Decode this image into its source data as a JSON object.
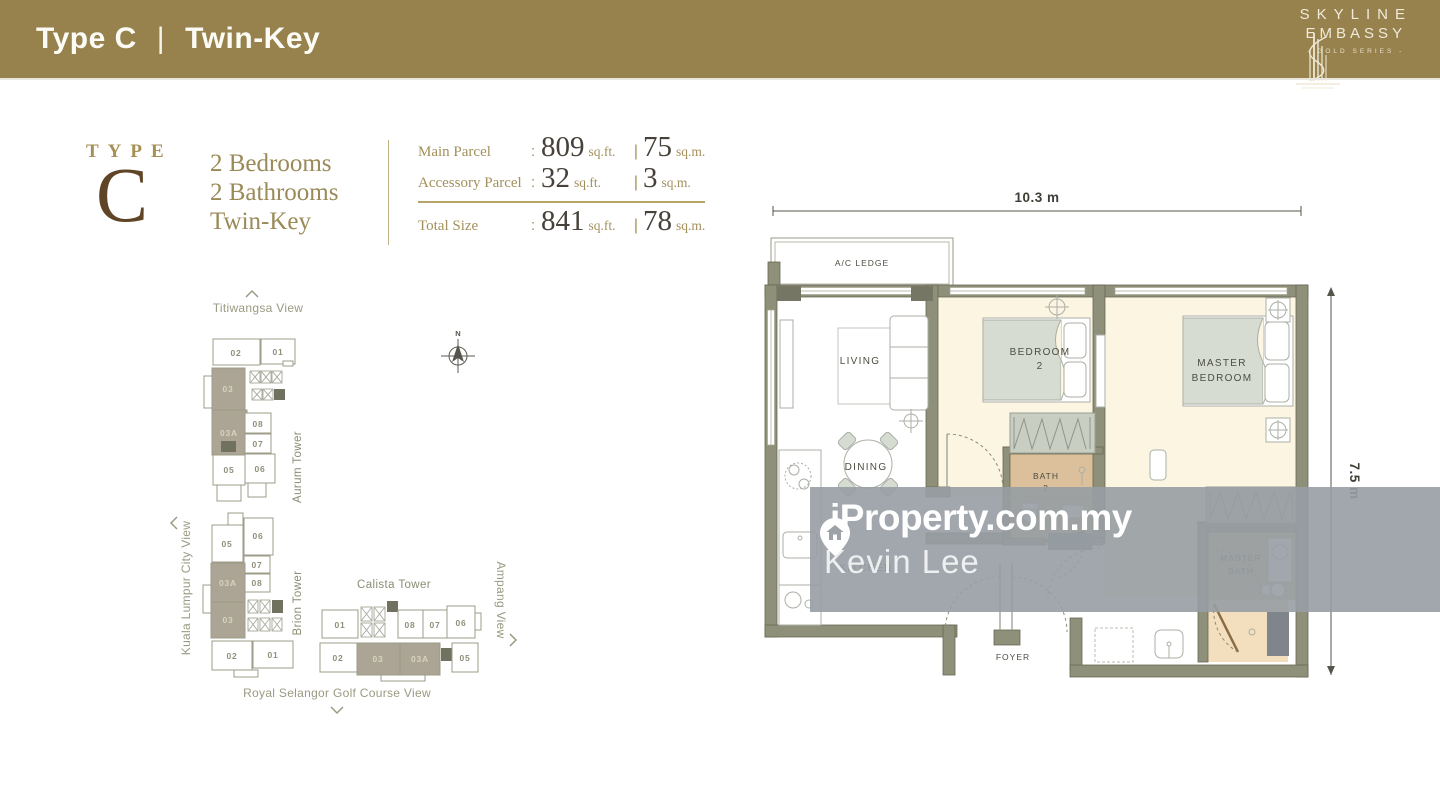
{
  "colors": {
    "header_bar": "#97824E",
    "accent_gold": "#A3905C",
    "type_letter_brown": "#5F4526",
    "highlight_unit": "#ACA595",
    "wall_olive": "#8F9079",
    "bedroom_floor_cream": "#FBF5E2",
    "bath_floor_tan": "#DCC09B",
    "watermark_band_gray": "#9AA0A6"
  },
  "header": {
    "title_left": "Type C",
    "separator": "|",
    "title_right": "Twin-Key",
    "brand": {
      "line1": "SKYLINE",
      "line2": "EMBASSY",
      "tagline": "- GOLD SERIES -"
    }
  },
  "unit_info": {
    "type_label": "TYPE",
    "type_letter": "C",
    "features": [
      "2 Bedrooms",
      "2 Bathrooms",
      "Twin-Key"
    ],
    "sizes": {
      "main": {
        "label": "Main Parcel",
        "colon": ":",
        "sqft": "809",
        "sqft_unit": "sq.ft.",
        "pipe": "|",
        "sqm": "75",
        "sqm_unit": "sq.m."
      },
      "accessory": {
        "label": "Accessory Parcel",
        "colon": ":",
        "sqft": "32",
        "sqft_unit": "sq.ft.",
        "pipe": "|",
        "sqm": "3",
        "sqm_unit": "sq.m."
      },
      "total": {
        "label": "Total Size",
        "colon": ":",
        "sqft": "841",
        "sqft_unit": "sq.ft.",
        "pipe": "|",
        "sqm": "78",
        "sqm_unit": "sq.m."
      }
    }
  },
  "site_plan": {
    "compass": "N",
    "views": {
      "top": "Titiwangsa View",
      "left": "Kuala Lumpur City View",
      "right": "Ampang View",
      "bottom": "Royal Selangor Golf Course View"
    },
    "towers": {
      "aurum": {
        "name": "Aurum Tower",
        "units": {
          "u02": "02",
          "u01": "01",
          "u03": "03",
          "u03a": "03A",
          "u05": "05",
          "u08": "08",
          "u07": "07",
          "u06": "06"
        }
      },
      "brion": {
        "name": "Brion Tower",
        "units": {
          "u05": "05",
          "u06": "06",
          "u07": "07",
          "u08": "08",
          "u03a": "03A",
          "u03": "03",
          "u02": "02",
          "u01": "01"
        }
      },
      "calista": {
        "name": "Calista Tower",
        "units": {
          "u01": "01",
          "u08": "08",
          "u07": "07",
          "u06": "06",
          "u02": "02",
          "u03": "03",
          "u03a": "03A",
          "u05": "05"
        }
      }
    },
    "highlighted_units": [
      "03",
      "03A"
    ]
  },
  "floor_plan": {
    "dimensions": {
      "width": "10.3 m",
      "height": "7.5 m"
    },
    "rooms": {
      "ac_ledge": "A/C LEDGE",
      "living": "LIVING",
      "dining": "DINING",
      "kitchen": "KITCHEN",
      "bedroom2_line1": "BEDROOM",
      "bedroom2_line2": "2",
      "master_bedroom_line1": "MASTER",
      "master_bedroom_line2": "BEDROOM",
      "bath2_line1": "BATH",
      "bath2_line2": "2",
      "master_bath_line1": "MASTER",
      "master_bath_line2": "BATH",
      "foyer": "FOYER"
    }
  },
  "watermark": {
    "brand": "iProperty.com.my",
    "agent": "Kevin Lee"
  }
}
